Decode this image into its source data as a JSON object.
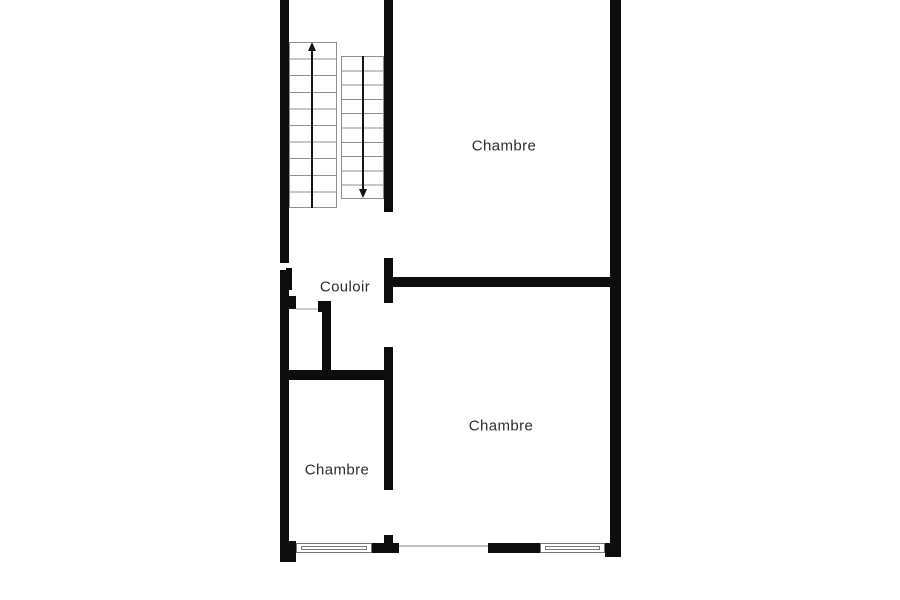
{
  "floorplan": {
    "labels": {
      "chambre_top": "Chambre",
      "couloir": "Couloir",
      "chambre_middle": "Chambre",
      "chambre_bottom_left": "Chambre"
    },
    "stairs": {
      "up_arrow_icon": "up-arrow",
      "down_arrow_icon": "down-arrow"
    },
    "windows": [
      "window-bottom-left",
      "window-bottom-right"
    ],
    "colors": {
      "wall": "#0d0d0d",
      "background": "#ffffff",
      "stair_line": "#8f8f8f",
      "window_frame": "#777777",
      "opening_line": "#c4c4c4",
      "label_text": "#2d2d2d"
    }
  }
}
